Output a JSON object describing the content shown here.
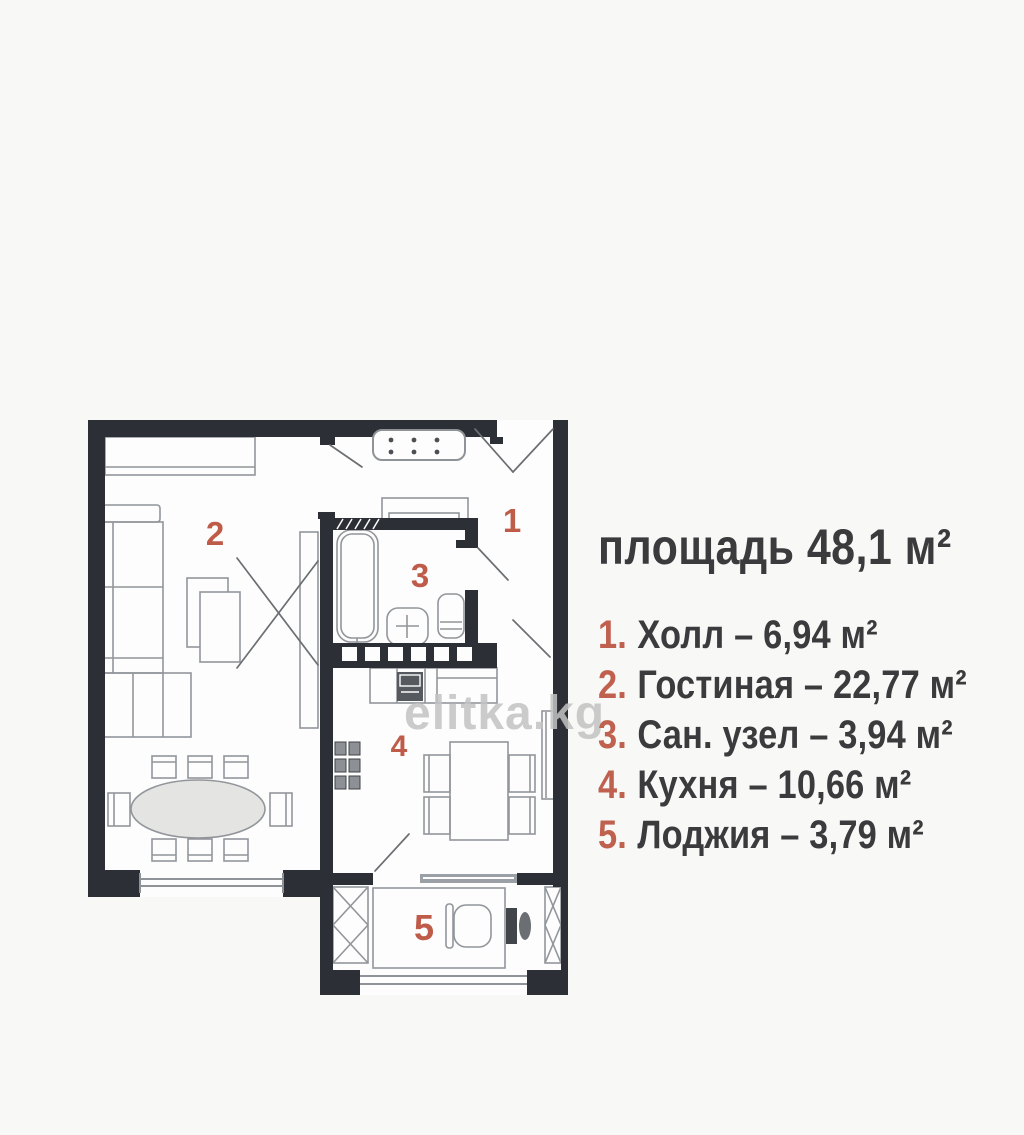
{
  "plan": {
    "room_numbers": [
      "1",
      "2",
      "3",
      "4",
      "5"
    ],
    "rooms": [
      {
        "number": "1",
        "name": "Холл",
        "area": "6,94 м²"
      },
      {
        "number": "2",
        "name": "Гостиная",
        "area": "22,77 м²"
      },
      {
        "number": "3",
        "name": "Сан. узел",
        "area": "3,94 м²"
      },
      {
        "number": "4",
        "name": "Кухня",
        "area": "10,66 м²"
      },
      {
        "number": "5",
        "name": "Лоджия",
        "area": "3,79 м²"
      }
    ],
    "colors": {
      "wall": "#2c2f35",
      "furniture_line": "#92959a",
      "room_number": "#bf5b49"
    }
  },
  "legend": {
    "title": "площадь 48,1 м²",
    "items": [
      {
        "num": "1.",
        "label": "Холл – 6,94 м²"
      },
      {
        "num": "2.",
        "label": "Гостиная – 22,77 м²"
      },
      {
        "num": "3.",
        "label": "Сан. узел – 3,94 м²"
      },
      {
        "num": "4.",
        "label": "Кухня – 10,66 м²"
      },
      {
        "num": "5.",
        "label": "Лоджия – 3,79 м²"
      }
    ],
    "text_color": "#3b3b3d",
    "number_color": "#c0604e"
  },
  "watermark": {
    "text": "elitka.kg"
  }
}
